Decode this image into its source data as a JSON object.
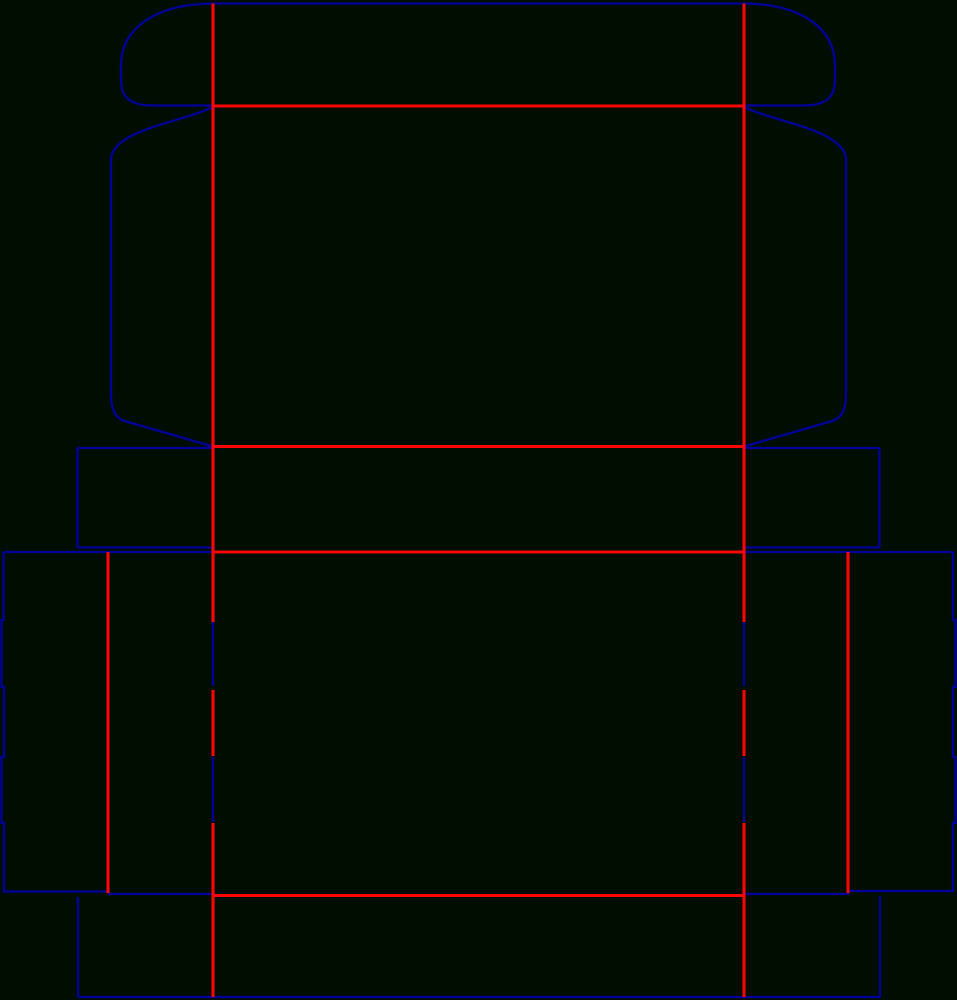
{
  "figure": {
    "kind": "box-dieline-template",
    "canvas": {
      "width": 957,
      "height": 1000,
      "background": "#020D02"
    },
    "styles": {
      "cut": {
        "color": "#00009C",
        "width": 2.3
      },
      "crease": {
        "color": "#FA0606",
        "width": 3.1
      }
    },
    "crease_segments": [
      [
        213,
        3.5,
        213,
        622
      ],
      [
        213,
        690,
        213,
        756
      ],
      [
        213,
        823,
        213,
        997
      ],
      [
        744,
        3.5,
        744,
        622
      ],
      [
        744,
        690,
        744,
        756
      ],
      [
        744,
        823,
        744,
        997
      ],
      [
        108,
        552,
        108,
        893
      ],
      [
        848,
        552,
        848,
        893
      ],
      [
        213,
        106,
        744,
        106
      ],
      [
        213,
        446.5,
        744,
        446.5
      ],
      [
        213,
        552,
        744,
        552
      ],
      [
        213,
        895.5,
        744,
        895.5
      ]
    ],
    "cut_segments": [
      [
        213,
        3.5,
        744,
        3.5
      ],
      [
        77.5,
        448,
        213,
        448
      ],
      [
        77.5,
        448,
        77.5,
        547.5
      ],
      [
        77.5,
        547.5,
        213,
        547.5
      ],
      [
        744,
        448,
        879.5,
        448
      ],
      [
        879.5,
        448,
        879.5,
        547.5
      ],
      [
        744,
        547.5,
        879.5,
        547.5
      ],
      [
        3.5,
        552,
        213,
        552
      ],
      [
        744,
        552,
        953,
        552
      ],
      [
        213,
        622,
        213,
        686
      ],
      [
        213,
        757,
        213,
        822
      ],
      [
        744,
        622,
        744,
        686
      ],
      [
        744,
        757,
        744,
        822
      ],
      [
        108,
        894,
        213,
        894
      ],
      [
        744,
        894,
        849,
        894
      ],
      [
        78,
        897,
        78,
        997
      ],
      [
        78,
        997,
        880,
        997
      ],
      [
        880,
        896,
        880,
        997
      ]
    ],
    "cut_paths": [
      "M213 3.5 C157 4 121 27 121 66 L121 80 C121 98 131 105.5 153 105.5 L213 105.5",
      "M744 3.5 C800 4 835 27 835 66 L835 80 C835 98 825 105.5 803 105.5 L744 105.5",
      "M213 107 C183 122 111 130 111 160 L111 393 C111 410 115 416.5 123 420.5 L213 446.5",
      "M744 107 C774 122 846 130 846 160 L846 393 C846 410 842 416.5 834 420.5 L744 446.5",
      "M3.5 552 L3.5 620 L1.5 620 L1.5 687 L4 687 L4 757 L1.5 757 L1.5 823 L4 823 L4 891.5 L107 891.5",
      "M953 552 L953 620 L955.5 620 L955.5 687 L953 687 L953 757 L955.5 757 L955.5 823 L953 823 L953 891 L850 891"
    ]
  }
}
